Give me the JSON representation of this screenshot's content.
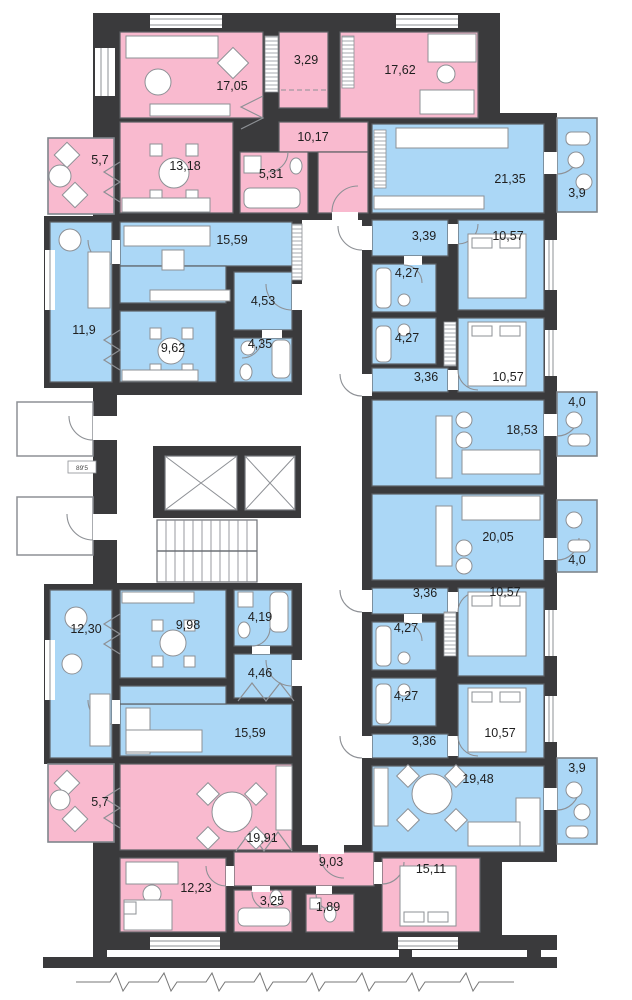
{
  "title": "Residential building floor plan",
  "palette": {
    "room_pink": "#F9BACF",
    "room_blue": "#ABD7F6",
    "wall": "#3A3A3C",
    "paper": "#FFFFFF",
    "room_stroke": "#5C5F63",
    "balcony_stroke": "#7F858C",
    "line": "#8D9095",
    "label": "#1F1F1F"
  },
  "core": {
    "label": "89'5"
  },
  "rooms": [
    {
      "area": "17,05",
      "color": "pink",
      "rect": [
        120,
        32,
        143,
        86
      ],
      "label": [
        232,
        90
      ]
    },
    {
      "area": "3,29",
      "color": "pink",
      "rect": [
        279,
        32,
        49,
        76
      ],
      "label": [
        306,
        64
      ]
    },
    {
      "area": "17,62",
      "color": "pink",
      "rect": [
        340,
        32,
        138,
        86
      ],
      "label": [
        400,
        74
      ]
    },
    {
      "area": "10,17",
      "color": "pink",
      "rect": [
        279,
        122,
        89,
        30
      ],
      "label": [
        313,
        141
      ]
    },
    {
      "area": "",
      "color": "pink",
      "rect": [
        318,
        152,
        50,
        61
      ]
    },
    {
      "area": "13,18",
      "color": "pink",
      "rect": [
        120,
        122,
        113,
        91
      ],
      "label": [
        185,
        170
      ]
    },
    {
      "area": "5,31",
      "color": "pink",
      "rect": [
        240,
        152,
        68,
        61
      ],
      "label": [
        271,
        178
      ]
    },
    {
      "area": "5,7",
      "color": "pink",
      "kind": "balcony",
      "rect": [
        48,
        138,
        66,
        76
      ],
      "label": [
        100,
        164
      ]
    },
    {
      "area": "21,35",
      "color": "blue",
      "rect": [
        372,
        124,
        172,
        89
      ],
      "label": [
        510,
        183
      ]
    },
    {
      "area": "3,9",
      "color": "blue",
      "kind": "balcony",
      "rect": [
        557,
        118,
        40,
        94
      ],
      "label": [
        577,
        197
      ]
    },
    {
      "area": "15,59",
      "color": "blue",
      "rect": [
        120,
        222,
        172,
        44
      ],
      "label": [
        232,
        244
      ]
    },
    {
      "area": "",
      "color": "blue",
      "rect": [
        120,
        266,
        106,
        37
      ]
    },
    {
      "area": "11,9",
      "color": "blue",
      "rect": [
        50,
        222,
        62,
        160
      ],
      "label": [
        84,
        334
      ]
    },
    {
      "area": "9,62",
      "color": "blue",
      "rect": [
        120,
        311,
        96,
        71
      ],
      "label": [
        173,
        352
      ]
    },
    {
      "area": "4,53",
      "color": "blue",
      "rect": [
        234,
        272,
        58,
        58
      ],
      "label": [
        263,
        305
      ]
    },
    {
      "area": "4,35",
      "color": "blue",
      "rect": [
        234,
        338,
        58,
        44
      ],
      "label": [
        260,
        348
      ]
    },
    {
      "area": "3,39",
      "color": "blue",
      "rect": [
        372,
        220,
        76,
        36
      ],
      "label": [
        424,
        240
      ]
    },
    {
      "area": "10,57",
      "color": "blue",
      "rect": [
        458,
        220,
        86,
        90
      ],
      "label": [
        508,
        240
      ]
    },
    {
      "area": "4,27",
      "color": "blue",
      "rect": [
        372,
        264,
        64,
        48
      ],
      "label": [
        407,
        277
      ]
    },
    {
      "area": "4,27",
      "color": "blue",
      "rect": [
        372,
        318,
        64,
        46
      ],
      "label": [
        407,
        342
      ]
    },
    {
      "area": "3,36",
      "color": "blue",
      "rect": [
        372,
        368,
        76,
        24
      ],
      "label": [
        426,
        381
      ]
    },
    {
      "area": "10,57",
      "color": "blue",
      "rect": [
        458,
        318,
        86,
        74
      ],
      "label": [
        508,
        381
      ]
    },
    {
      "area": "18,53",
      "color": "blue",
      "rect": [
        372,
        400,
        172,
        86
      ],
      "label": [
        522,
        434
      ]
    },
    {
      "area": "4,0",
      "color": "blue",
      "kind": "balcony",
      "rect": [
        557,
        392,
        40,
        64
      ],
      "label": [
        577,
        406
      ]
    },
    {
      "area": "20,05",
      "color": "blue",
      "rect": [
        372,
        494,
        172,
        86
      ],
      "label": [
        498,
        541
      ]
    },
    {
      "area": "4,0",
      "color": "blue",
      "kind": "balcony",
      "rect": [
        557,
        500,
        40,
        72
      ],
      "label": [
        577,
        564
      ]
    },
    {
      "area": "3,36",
      "color": "blue",
      "rect": [
        372,
        588,
        76,
        26
      ],
      "label": [
        425,
        597
      ]
    },
    {
      "area": "10,57",
      "color": "blue",
      "rect": [
        458,
        588,
        86,
        88
      ],
      "label": [
        505,
        596
      ]
    },
    {
      "area": "4,27",
      "color": "blue",
      "rect": [
        372,
        622,
        64,
        48
      ],
      "label": [
        406,
        632
      ]
    },
    {
      "area": "4,27",
      "color": "blue",
      "rect": [
        372,
        678,
        64,
        48
      ],
      "label": [
        406,
        700
      ]
    },
    {
      "area": "3,36",
      "color": "blue",
      "rect": [
        372,
        734,
        76,
        24
      ],
      "label": [
        424,
        745
      ]
    },
    {
      "area": "10,57",
      "color": "blue",
      "rect": [
        458,
        684,
        86,
        74
      ],
      "label": [
        500,
        737
      ]
    },
    {
      "area": "19,48",
      "color": "blue",
      "rect": [
        372,
        766,
        172,
        86
      ],
      "label": [
        478,
        783
      ]
    },
    {
      "area": "3,9",
      "color": "blue",
      "kind": "balcony",
      "rect": [
        557,
        758,
        40,
        86
      ],
      "label": [
        577,
        772
      ]
    },
    {
      "area": "12,30",
      "color": "blue",
      "rect": [
        50,
        590,
        62,
        168
      ],
      "label": [
        86,
        633
      ]
    },
    {
      "area": "9,98",
      "color": "blue",
      "rect": [
        120,
        590,
        106,
        88
      ],
      "label": [
        188,
        629
      ]
    },
    {
      "area": "4,19",
      "color": "blue",
      "rect": [
        234,
        590,
        58,
        56
      ],
      "label": [
        260,
        621
      ]
    },
    {
      "area": "4,46",
      "color": "blue",
      "rect": [
        234,
        654,
        58,
        44
      ],
      "label": [
        260,
        677
      ]
    },
    {
      "area": "15,59",
      "color": "blue",
      "rect": [
        120,
        704,
        172,
        52
      ],
      "label": [
        250,
        737
      ]
    },
    {
      "area": "",
      "color": "blue",
      "rect": [
        120,
        686,
        106,
        18
      ]
    },
    {
      "area": "5,7",
      "color": "pink",
      "kind": "balcony",
      "rect": [
        48,
        764,
        66,
        78
      ],
      "label": [
        100,
        806
      ]
    },
    {
      "area": "19,91",
      "color": "pink",
      "rect": [
        120,
        764,
        172,
        86
      ],
      "label": [
        262,
        842
      ]
    },
    {
      "area": "12,23",
      "color": "pink",
      "rect": [
        120,
        858,
        106,
        74
      ],
      "label": [
        196,
        892
      ]
    },
    {
      "area": "9,03",
      "color": "pink",
      "rect": [
        234,
        852,
        140,
        34
      ],
      "label": [
        331,
        866
      ]
    },
    {
      "area": "3,25",
      "color": "pink",
      "rect": [
        234,
        890,
        58,
        42
      ],
      "label": [
        272,
        905
      ]
    },
    {
      "area": "1,89",
      "color": "pink",
      "rect": [
        306,
        894,
        48,
        38
      ],
      "label": [
        328,
        911
      ]
    },
    {
      "area": "15,11",
      "color": "pink",
      "rect": [
        382,
        858,
        98,
        74
      ],
      "label": [
        431,
        873
      ]
    }
  ]
}
